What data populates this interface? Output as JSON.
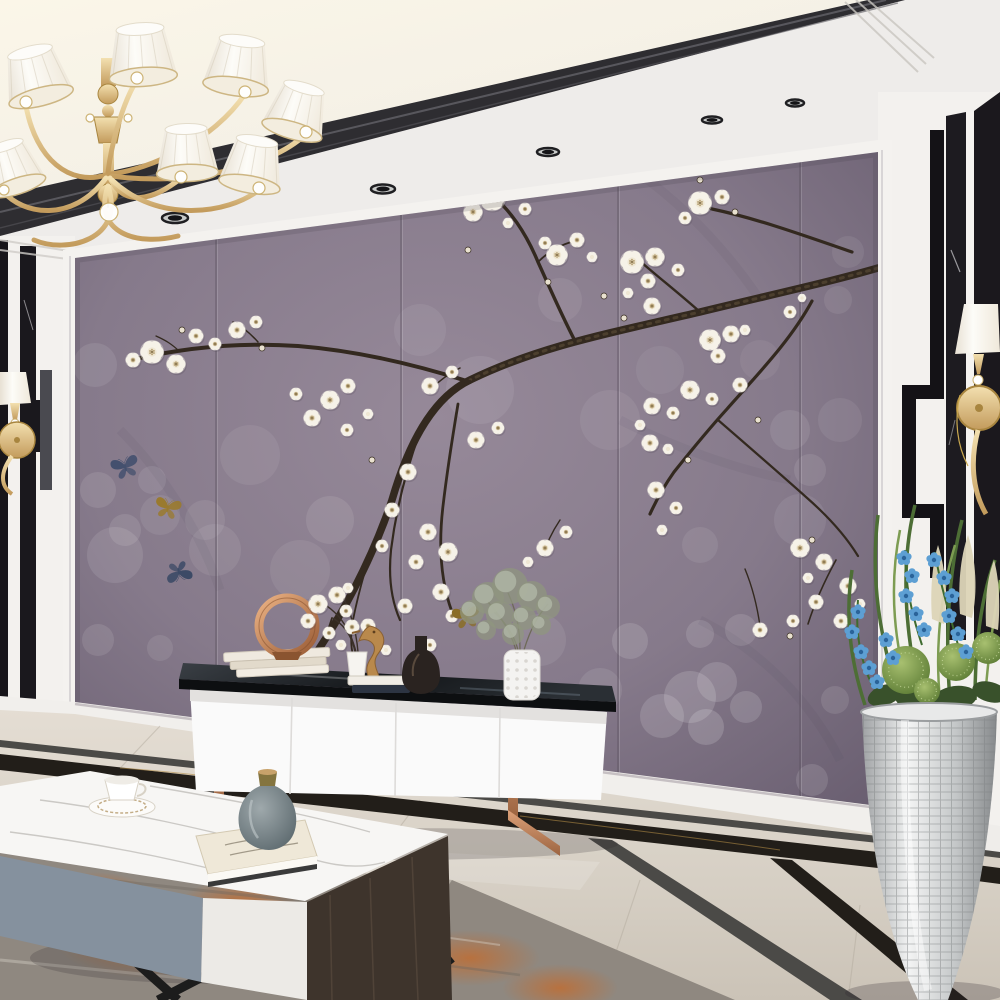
{
  "meta": {
    "title": "Modern living room with plum-blossom mural TV wall",
    "scene_type": "interior photo",
    "objects": [
      "chandelier",
      "plum-blossom-mural",
      "tv-cabinet",
      "coffee-table",
      "silver-planter",
      "wall-sconce-left",
      "wall-sconce-right",
      "area-rug",
      "marble-floor",
      "copper-ring-sculpture",
      "seahorse-figurine",
      "dark-glass-vase",
      "spiky-white-vase",
      "bud-vase-with-plum-sprig",
      "book-stacks",
      "coffee-cup",
      "grey-ceramic-vase",
      "butterflies"
    ]
  },
  "palette": {
    "mural_bg": "#877a88",
    "mural_dark": "#675c6c",
    "mural_light": "#9a8d9b",
    "branch": "#33291f",
    "blossom": "#f6f2e8",
    "blossom_center": "#efe7d3",
    "seam": "#5e5462",
    "ceiling_white": "#f0eeeb",
    "ceiling_warm": "#f8f2e0",
    "ceiling_strip": "#2e2d31",
    "wall_white": "#f3f1ee",
    "black_marble": "#151317",
    "velvet_black": "#1b181d",
    "gold": "#d7bb87",
    "gold_deep": "#b08f4f",
    "rose_gold": "#c08a62",
    "copper": "#c87f4e",
    "cabinet_white": "#fafafa",
    "glass_dark": "#1b1e22",
    "floor_light": "#e2dbd1",
    "floor_dark": "#c4bcb0",
    "strip_gold_black": "#221e19",
    "strip_grey": "#4b4a47",
    "rug_grey": "#8f8880",
    "rug_orange": "#b96f35",
    "marble_top": "#f7f6f4",
    "table_grey": "#85919e",
    "table_wood": "#3e342c",
    "leg_black": "#1c1c1c",
    "vase_grey": "#6f7d82",
    "vase_wood": "#c8a26b",
    "plant_green": "#4d6e35",
    "plant_green_light": "#7d9c52",
    "orchid_blue": "#5d9fd3",
    "frond_cream": "#ddd5b8",
    "planter_silver": "#c9cbcc",
    "shade_white": "#f7f4ec"
  },
  "mural": {
    "frame": {
      "left": 75,
      "top_left": 258,
      "right": 878,
      "top_right": 152,
      "bottom_left": 712,
      "bottom_right": 818
    },
    "seams_x": [
      216,
      401,
      618,
      800
    ],
    "branches": [
      {
        "d": "M878,268 C830,282 770,295 700,312 C610,333 540,346 470,380 C432,398 408,445 392,500 C372,560 340,620 306,668 C292,690 280,704 272,714",
        "w": 7.5
      },
      {
        "d": "M878,268 C830,282 770,295 700,312 C610,333 540,346 470,380",
        "w": 3,
        "overlay": true
      },
      {
        "d": "M852,252 C800,234 755,218 712,209 C706,207 701,204 698,202",
        "w": 3.2
      },
      {
        "d": "M700,312 C682,296 662,280 648,268 C641,262 635,258 631,255",
        "w": 2.4
      },
      {
        "d": "M575,341 C560,312 549,286 538,262 C526,233 509,208 491,195",
        "w": 3.4
      },
      {
        "d": "M538,262 C548,252 558,246 571,242",
        "w": 1.8
      },
      {
        "d": "M812,301 C791,340 757,375 727,409 C707,431 690,452 674,472 C662,489 655,503 650,514",
        "w": 3.2
      },
      {
        "d": "M718,420 C748,446 778,472 806,497 C830,518 847,538 858,556",
        "w": 2.2
      },
      {
        "d": "M836,560 C824,582 814,605 808,624",
        "w": 1.6
      },
      {
        "d": "M470,382 C420,366 360,351 298,346 C240,342 186,347 131,360",
        "w": 4
      },
      {
        "d": "M258,342 C250,333 243,327 233,322",
        "w": 1.5
      },
      {
        "d": "M180,352 C172,344 165,340 156,336",
        "w": 1.3
      },
      {
        "d": "M458,404 C452,440 447,472 443,506 C438,548 441,582 452,612",
        "w": 2.8
      },
      {
        "d": "M420,432 C406,470 396,510 391,550 C388,580 392,602 400,620",
        "w": 2.2
      },
      {
        "d": "M388,505 C372,545 360,585 353,620 C349,642 352,658 358,668",
        "w": 1.8
      },
      {
        "d": "M332,618 C322,648 314,674 308,700",
        "w": 1.8
      },
      {
        "d": "M760,626 C757,605 752,586 745,569",
        "w": 1.4
      },
      {
        "d": "M560,520 C552,532 546,545 543,556",
        "w": 1.4
      },
      {
        "d": "M430,390 C440,380 450,373 460,368",
        "w": 1.5
      }
    ],
    "creases": [
      "M600,150 C660,180 720,240 760,300",
      "M620,420 C680,450 740,470 790,480",
      "M700,620 C760,650 810,700 840,760",
      "M120,430 C160,470 200,530 220,590"
    ],
    "blossoms": [
      [
        492,
        197,
        13
      ],
      [
        513,
        184,
        10
      ],
      [
        473,
        212,
        9
      ],
      [
        525,
        209,
        6
      ],
      [
        508,
        223,
        5
      ],
      [
        545,
        243,
        6
      ],
      [
        557,
        255,
        10
      ],
      [
        577,
        240,
        7
      ],
      [
        592,
        257,
        5
      ],
      [
        632,
        262,
        11
      ],
      [
        655,
        257,
        9
      ],
      [
        648,
        281,
        7
      ],
      [
        678,
        270,
        6
      ],
      [
        652,
        306,
        8
      ],
      [
        628,
        293,
        5
      ],
      [
        700,
        203,
        11
      ],
      [
        722,
        197,
        7
      ],
      [
        685,
        218,
        6
      ],
      [
        790,
        312,
        6
      ],
      [
        802,
        298,
        4
      ],
      [
        710,
        340,
        10
      ],
      [
        731,
        334,
        8
      ],
      [
        718,
        356,
        7
      ],
      [
        745,
        330,
        5
      ],
      [
        740,
        385,
        7
      ],
      [
        690,
        390,
        9
      ],
      [
        712,
        399,
        6
      ],
      [
        652,
        406,
        8
      ],
      [
        673,
        413,
        6
      ],
      [
        650,
        443,
        8
      ],
      [
        668,
        449,
        5
      ],
      [
        640,
        425,
        5
      ],
      [
        656,
        490,
        8
      ],
      [
        676,
        508,
        6
      ],
      [
        662,
        530,
        5
      ],
      [
        800,
        548,
        9
      ],
      [
        824,
        562,
        8
      ],
      [
        848,
        586,
        8
      ],
      [
        816,
        602,
        7
      ],
      [
        793,
        621,
        6
      ],
      [
        841,
        621,
        7
      ],
      [
        860,
        604,
        5
      ],
      [
        808,
        578,
        5
      ],
      [
        152,
        352,
        11
      ],
      [
        176,
        364,
        9
      ],
      [
        133,
        360,
        7
      ],
      [
        196,
        336,
        7
      ],
      [
        215,
        344,
        6
      ],
      [
        237,
        330,
        8
      ],
      [
        256,
        322,
        6
      ],
      [
        330,
        400,
        9
      ],
      [
        348,
        386,
        7
      ],
      [
        312,
        418,
        8
      ],
      [
        347,
        430,
        6
      ],
      [
        296,
        394,
        6
      ],
      [
        368,
        414,
        5
      ],
      [
        430,
        386,
        8
      ],
      [
        452,
        372,
        6
      ],
      [
        476,
        440,
        8
      ],
      [
        498,
        428,
        6
      ],
      [
        408,
        472,
        8
      ],
      [
        392,
        510,
        7
      ],
      [
        428,
        532,
        8
      ],
      [
        448,
        552,
        9
      ],
      [
        416,
        562,
        7
      ],
      [
        382,
        546,
        6
      ],
      [
        441,
        592,
        8
      ],
      [
        405,
        606,
        7
      ],
      [
        368,
        626,
        7
      ],
      [
        348,
        588,
        5
      ],
      [
        452,
        616,
        6
      ],
      [
        430,
        645,
        6
      ],
      [
        386,
        650,
        5
      ],
      [
        545,
        548,
        8
      ],
      [
        566,
        532,
        6
      ],
      [
        528,
        562,
        5
      ],
      [
        760,
        630,
        7
      ]
    ],
    "buds": [
      [
        468,
        250,
        3
      ],
      [
        604,
        296,
        3
      ],
      [
        548,
        282,
        3
      ],
      [
        624,
        318,
        3
      ],
      [
        758,
        420,
        3
      ],
      [
        688,
        460,
        3
      ],
      [
        372,
        460,
        3
      ],
      [
        304,
        660,
        3
      ],
      [
        182,
        330,
        3
      ],
      [
        262,
        348,
        3
      ],
      [
        812,
        540,
        3
      ],
      [
        790,
        636,
        3
      ],
      [
        700,
        180,
        3
      ],
      [
        735,
        212,
        3
      ]
    ],
    "bokeh": [
      [
        115,
        555,
        28,
        0.1
      ],
      [
        160,
        515,
        20,
        0.08
      ],
      [
        98,
        490,
        18,
        0.1
      ],
      [
        152,
        480,
        14,
        0.09
      ],
      [
        125,
        530,
        16,
        0.1
      ],
      [
        205,
        520,
        20,
        0.08
      ],
      [
        95,
        365,
        22,
        0.09
      ],
      [
        250,
        455,
        30,
        0.07
      ],
      [
        215,
        550,
        26,
        0.08
      ],
      [
        330,
        520,
        24,
        0.09
      ],
      [
        300,
        570,
        30,
        0.07
      ],
      [
        420,
        330,
        26,
        0.07
      ],
      [
        480,
        390,
        34,
        0.08
      ],
      [
        560,
        300,
        22,
        0.07
      ],
      [
        610,
        420,
        30,
        0.07
      ],
      [
        660,
        370,
        24,
        0.06
      ],
      [
        630,
        641,
        18,
        0.13
      ],
      [
        700,
        634,
        14,
        0.12
      ],
      [
        741,
        630,
        16,
        0.12
      ],
      [
        690,
        697,
        26,
        0.15
      ],
      [
        717,
        682,
        20,
        0.14
      ],
      [
        662,
        716,
        22,
        0.14
      ],
      [
        706,
        727,
        18,
        0.16
      ],
      [
        746,
        707,
        16,
        0.14
      ],
      [
        812,
        780,
        16,
        0.12
      ],
      [
        835,
        700,
        14,
        0.1
      ],
      [
        800,
        520,
        26,
        0.08
      ],
      [
        840,
        420,
        22,
        0.07
      ],
      [
        760,
        360,
        20,
        0.06
      ],
      [
        848,
        252,
        16,
        0.07
      ],
      [
        838,
        300,
        14,
        0.08
      ],
      [
        790,
        430,
        20,
        0.09
      ],
      [
        810,
        470,
        16,
        0.09
      ],
      [
        700,
        545,
        18,
        0.08
      ],
      [
        98,
        640,
        16,
        0.1
      ],
      [
        160,
        648,
        13,
        0.09
      ],
      [
        250,
        700,
        18,
        0.1
      ],
      [
        110,
        730,
        20,
        0.12
      ],
      [
        190,
        742,
        16,
        0.12
      ],
      [
        540,
        640,
        26,
        0.08
      ],
      [
        600,
        690,
        22,
        0.09
      ]
    ],
    "butterflies": [
      {
        "x": 125,
        "y": 466,
        "c": "#44506e",
        "rot": -15,
        "s": 0.85
      },
      {
        "x": 168,
        "y": 507,
        "c": "#9a7a2e",
        "rot": 12,
        "s": 0.8
      },
      {
        "x": 179,
        "y": 573,
        "c": "#3c4a66",
        "rot": 168,
        "s": 0.8
      },
      {
        "x": 466,
        "y": 616,
        "c": "#8a6d26",
        "rot": -8,
        "s": 0.85
      }
    ]
  },
  "ceiling": {
    "downlights": [
      [
        175,
        218,
        13,
        5
      ],
      [
        383,
        189,
        12,
        4.5
      ],
      [
        548,
        152,
        11,
        4
      ],
      [
        712,
        120,
        10,
        3.5
      ],
      [
        795,
        103,
        9,
        3.5
      ],
      [
        962,
        99,
        13,
        5.5
      ]
    ]
  },
  "chandelier": {
    "shades": [
      [
        30,
        52,
        23,
        33,
        46,
        -14
      ],
      [
        140,
        29,
        24,
        34,
        48,
        -4
      ],
      [
        242,
        41,
        23,
        33,
        46,
        8
      ],
      [
        304,
        88,
        21,
        31,
        44,
        16
      ],
      [
        186,
        129,
        21,
        31,
        44,
        -2
      ],
      [
        257,
        141,
        21,
        31,
        44,
        10
      ],
      [
        5,
        146,
        19,
        29,
        42,
        -18
      ]
    ],
    "arms": [
      "M106,175 C70,186 36,160 26,106",
      "M108,172 C112,140 124,100 137,80",
      "M110,174 C150,170 214,140 245,94",
      "M112,176 C180,186 268,170 306,134",
      "M110,178 C124,208 154,200 181,178",
      "M112,180 C158,224 228,214 259,190",
      "M106,178 C72,224 22,214 4,192",
      "M108,186 C92,234 138,246 178,236",
      "M108,186 C126,240 66,254 34,240"
    ],
    "crystals": [
      [
        26,
        102,
        6
      ],
      [
        137,
        78,
        6
      ],
      [
        245,
        92,
        6
      ],
      [
        306,
        132,
        6
      ],
      [
        181,
        177,
        6
      ],
      [
        259,
        188,
        6
      ],
      [
        4,
        190,
        5
      ],
      [
        109,
        212,
        9
      ],
      [
        90,
        118,
        4
      ],
      [
        128,
        118,
        4
      ]
    ]
  },
  "decor": {
    "sprig": {
      "stems": [
        "M356,652 C350,628 338,612 322,603",
        "M358,652 C356,628 350,611 343,597",
        "M355,652 C352,636 344,625 333,618"
      ],
      "flowers": [
        [
          318,
          604,
          9
        ],
        [
          337,
          595,
          8
        ],
        [
          308,
          621,
          7
        ],
        [
          346,
          611,
          6
        ],
        [
          352,
          627,
          7
        ],
        [
          329,
          633,
          6
        ],
        [
          341,
          645,
          5
        ]
      ]
    },
    "dried_bouquet": {
      "stems": [
        "M516,650 C510,630 500,615 488,602",
        "M520,650 C520,628 516,610 508,593",
        "M524,650 C530,630 538,615 548,604",
        "M518,650 C514,635 505,622 494,612"
      ],
      "blobs": [
        [
          488,
          598,
          16
        ],
        [
          510,
          586,
          18
        ],
        [
          532,
          596,
          15
        ],
        [
          548,
          607,
          12
        ],
        [
          472,
          612,
          12
        ],
        [
          500,
          615,
          14
        ],
        [
          524,
          618,
          12
        ],
        [
          541,
          625,
          10
        ],
        [
          486,
          630,
          10
        ],
        [
          513,
          634,
          11
        ]
      ]
    }
  },
  "plant": {
    "orchids": [
      [
        858,
        612
      ],
      [
        852,
        632
      ],
      [
        861,
        652
      ],
      [
        869,
        668
      ],
      [
        877,
        682
      ],
      [
        904,
        558
      ],
      [
        912,
        576
      ],
      [
        906,
        596
      ],
      [
        916,
        614
      ],
      [
        924,
        630
      ],
      [
        934,
        560
      ],
      [
        944,
        578
      ],
      [
        952,
        596
      ],
      [
        949,
        616
      ],
      [
        958,
        634
      ],
      [
        966,
        652
      ],
      [
        886,
        640
      ],
      [
        893,
        658
      ]
    ],
    "pods": [
      [
        906,
        670,
        24
      ],
      [
        956,
        662,
        19
      ],
      [
        988,
        648,
        16
      ],
      [
        927,
        691,
        13
      ]
    ]
  },
  "rug": {
    "patches": [
      [
        150,
        940,
        95,
        38
      ],
      [
        320,
        950,
        85,
        32
      ],
      [
        470,
        958,
        70,
        28
      ],
      [
        240,
        902,
        60,
        22
      ],
      [
        95,
        892,
        52,
        20
      ],
      [
        560,
        988,
        58,
        24
      ],
      [
        390,
        912,
        48,
        18
      ]
    ]
  }
}
